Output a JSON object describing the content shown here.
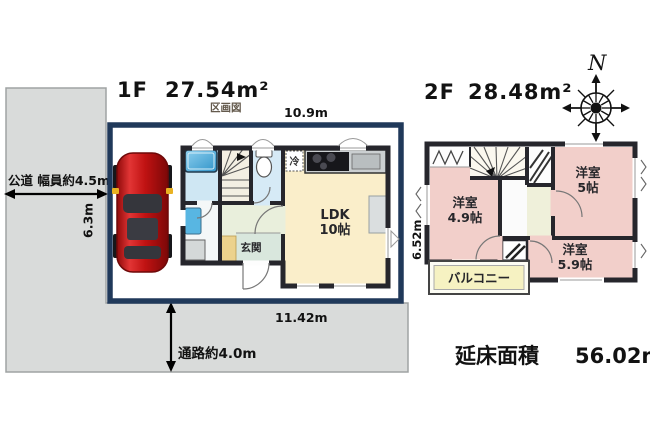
{
  "site": {
    "road_label": "公道 幅員約4.5m",
    "road_depth": "6.3m",
    "passage_label": "通路約4.0m"
  },
  "floor1": {
    "label": "1F",
    "area": "27.54m²",
    "subtitle": "区画図",
    "dim_top": "10.9m",
    "dim_bottom": "11.42m",
    "ldk_label": "LDK",
    "ldk_size": "10帖",
    "entrance_label": "玄関",
    "fridge_label": "冷"
  },
  "floor2": {
    "label": "2F",
    "area": "28.48m²",
    "dim_left": "6.52m",
    "rooms": [
      {
        "name": "洋室",
        "size": "4.9帖"
      },
      {
        "name": "洋室",
        "size": "5帖"
      },
      {
        "name": "洋室",
        "size": "5.9帖"
      }
    ],
    "balcony_label": "バルコニー"
  },
  "compass": {
    "north": "N"
  },
  "summary": {
    "label": "延床面積",
    "value": "56.02m²"
  },
  "colors": {
    "parcel_border": "#20395a",
    "road_fill": "#d9dbda",
    "wall": "#26262c",
    "ldk_floor": "#faeeca",
    "bath_floor": "#cfe7f3",
    "toilet_floor": "#d6eaf6",
    "hall_floor": "#e9efdc",
    "genkan_step": "#ecd28d",
    "room2f_floor": "#f2cfca",
    "hall2f_floor": "#eff0da",
    "balcony_fill": "#f6f2c2",
    "car_red": "#c41616",
    "tub_blue": "#3fa8dc"
  }
}
